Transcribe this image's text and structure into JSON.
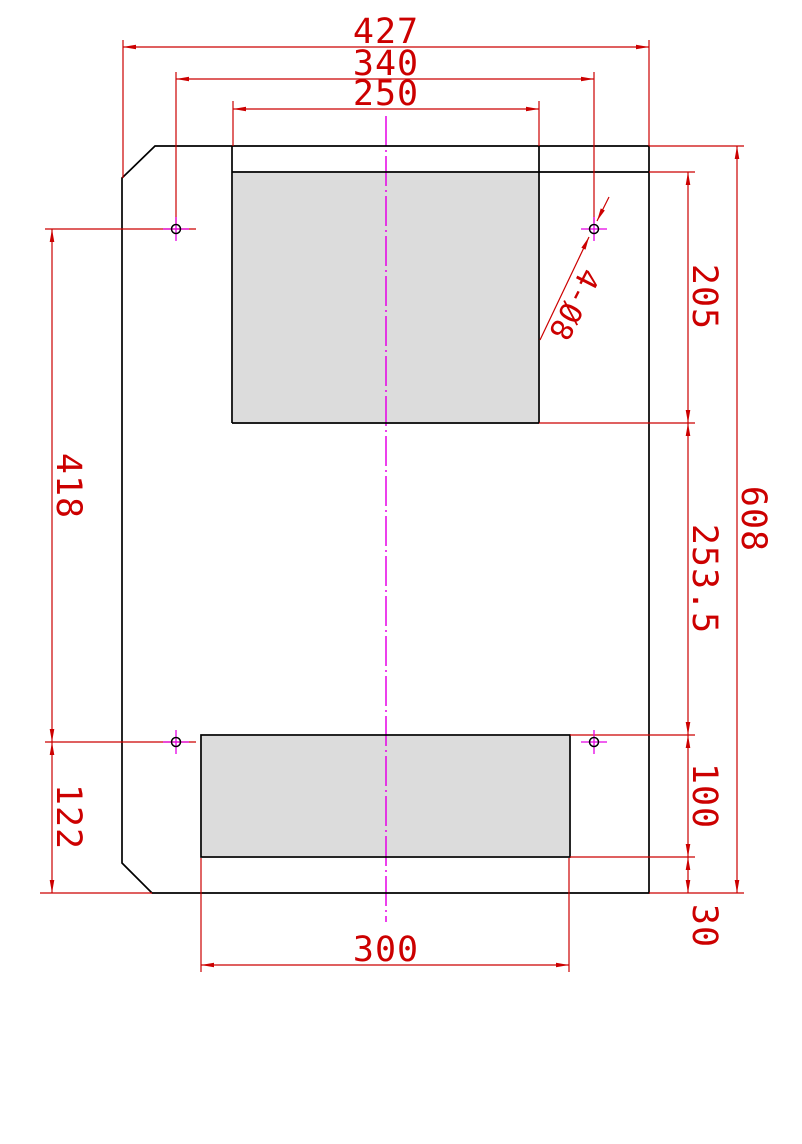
{
  "drawing": {
    "type": "cad-part-drawing",
    "dims": {
      "overall_width": "427",
      "hole_span_width": "340",
      "top_slot_width": "250",
      "top_slot_height": "205",
      "mid_section_height": "253.5",
      "hole_span_height": "418",
      "bottom_section_height": "122",
      "bottom_slot_height": "100",
      "bottom_margin": "30",
      "overall_height": "608",
      "bottom_slot_width": "300",
      "hole_callout": "4-Ø8"
    },
    "colors": {
      "outline": "#000000",
      "dimension": "#cc0000",
      "centerline": "#e500e5",
      "slot_fill": "#dcdcdc",
      "background": "#ffffff"
    }
  }
}
